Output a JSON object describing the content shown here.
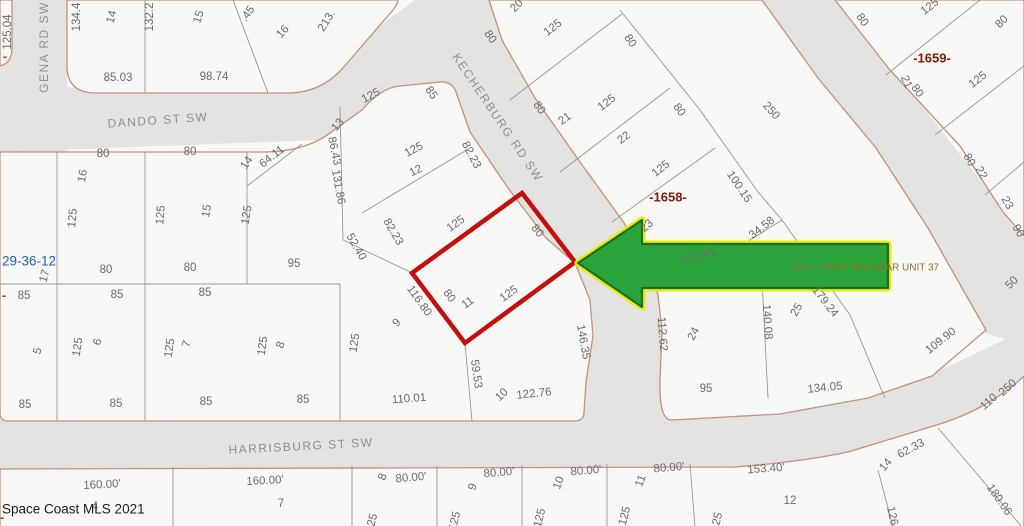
{
  "map": {
    "type": "plat-parcel-map",
    "watermark": "Space Coast MLS 2021",
    "section_label": "29-36-12",
    "streets": [
      "GENA RD SW",
      "DANDO ST SW",
      "KECHERBURG RD SW",
      "HARRISBURG ST SW"
    ],
    "plat_numbers": [
      "-1658-",
      "-1659-"
    ],
    "unit_label": "#KH - PORT MALABAR UNIT 37",
    "highlighted_parcel": {
      "lot": "11",
      "frontage": "80",
      "depth": "125"
    },
    "labels": [
      {
        "t": "125.04",
        "x": 8,
        "y": 32,
        "r": -90,
        "k": "d"
      },
      {
        "t": "-",
        "x": 5,
        "y": 57,
        "r": 0,
        "k": "rd"
      },
      {
        "t": "134.4",
        "x": 77,
        "y": 17,
        "r": -90,
        "k": "d"
      },
      {
        "t": "14",
        "x": 112,
        "y": 17,
        "r": -75,
        "k": "d"
      },
      {
        "t": "132.2",
        "x": 150,
        "y": 17,
        "r": -90,
        "k": "d"
      },
      {
        "t": "15",
        "x": 199,
        "y": 17,
        "r": -72,
        "k": "d"
      },
      {
        "t": ".45",
        "x": 248,
        "y": 14,
        "r": -55,
        "k": "d"
      },
      {
        "t": "16",
        "x": 283,
        "y": 32,
        "r": -48,
        "k": "d"
      },
      {
        "t": "213.",
        "x": 327,
        "y": 21,
        "r": -58,
        "k": "d"
      },
      {
        "t": "85.03",
        "x": 118,
        "y": 78,
        "r": 0,
        "k": "d"
      },
      {
        "t": "98.74",
        "x": 214,
        "y": 77,
        "r": 0,
        "k": "d"
      },
      {
        "t": "GENA RD SW",
        "x": 45,
        "y": 47,
        "r": -90,
        "k": "st"
      },
      {
        "t": "DANDO ST SW",
        "x": 158,
        "y": 121,
        "r": -4,
        "k": "st"
      },
      {
        "t": "80",
        "x": 103,
        "y": 154,
        "r": 0,
        "k": "d"
      },
      {
        "t": "80",
        "x": 190,
        "y": 152,
        "r": 0,
        "k": "d"
      },
      {
        "t": "14",
        "x": 247,
        "y": 163,
        "r": -55,
        "k": "d"
      },
      {
        "t": "64.11",
        "x": 272,
        "y": 157,
        "r": -38,
        "k": "d"
      },
      {
        "t": "16",
        "x": 83,
        "y": 176,
        "r": -80,
        "k": "d"
      },
      {
        "t": "125",
        "x": 73,
        "y": 218,
        "r": -85,
        "k": "d"
      },
      {
        "t": "125",
        "x": 161,
        "y": 215,
        "r": -85,
        "k": "d"
      },
      {
        "t": "15",
        "x": 207,
        "y": 211,
        "r": -80,
        "k": "d"
      },
      {
        "t": "125",
        "x": 247,
        "y": 215,
        "r": -80,
        "k": "d"
      },
      {
        "t": "29-36-12",
        "x": 2,
        "y": 262,
        "r": 0,
        "k": "sec"
      },
      {
        "t": "17",
        "x": 45,
        "y": 276,
        "r": -75,
        "k": "d"
      },
      {
        "t": "80",
        "x": 106,
        "y": 270,
        "r": 0,
        "k": "d"
      },
      {
        "t": "80",
        "x": 190,
        "y": 268,
        "r": 0,
        "k": "d"
      },
      {
        "t": "95",
        "x": 294,
        "y": 264,
        "r": 0,
        "k": "d"
      },
      {
        "t": "-",
        "x": 4,
        "y": 296,
        "r": 0,
        "k": "rd"
      },
      {
        "t": "85",
        "x": 24,
        "y": 296,
        "r": 0,
        "k": "d"
      },
      {
        "t": "85",
        "x": 117,
        "y": 295,
        "r": 0,
        "k": "d"
      },
      {
        "t": "85",
        "x": 205,
        "y": 293,
        "r": 0,
        "k": "d"
      },
      {
        "t": "5",
        "x": 38,
        "y": 351,
        "r": -75,
        "k": "d"
      },
      {
        "t": "125",
        "x": 78,
        "y": 347,
        "r": -82,
        "k": "d"
      },
      {
        "t": "6",
        "x": 98,
        "y": 342,
        "r": -75,
        "k": "d"
      },
      {
        "t": "125",
        "x": 170,
        "y": 348,
        "r": -82,
        "k": "d"
      },
      {
        "t": "7",
        "x": 187,
        "y": 344,
        "r": -75,
        "k": "d"
      },
      {
        "t": "125",
        "x": 263,
        "y": 346,
        "r": -82,
        "k": "d"
      },
      {
        "t": "8",
        "x": 281,
        "y": 345,
        "r": -70,
        "k": "d"
      },
      {
        "t": "125",
        "x": 355,
        "y": 343,
        "r": -82,
        "k": "d"
      },
      {
        "t": "9",
        "x": 397,
        "y": 323,
        "r": -45,
        "k": "d"
      },
      {
        "t": "85",
        "x": 25,
        "y": 405,
        "r": 0,
        "k": "d"
      },
      {
        "t": "85",
        "x": 116,
        "y": 404,
        "r": 0,
        "k": "d"
      },
      {
        "t": "85",
        "x": 206,
        "y": 402,
        "r": 0,
        "k": "d"
      },
      {
        "t": "85",
        "x": 303,
        "y": 400,
        "r": 0,
        "k": "d"
      },
      {
        "t": "110.01",
        "x": 409,
        "y": 399,
        "r": -4,
        "k": "d"
      },
      {
        "t": "59.53",
        "x": 476,
        "y": 374,
        "r": 82,
        "k": "d"
      },
      {
        "t": "10",
        "x": 502,
        "y": 395,
        "r": -45,
        "k": "d"
      },
      {
        "t": "122.76",
        "x": 534,
        "y": 394,
        "r": -6,
        "k": "d"
      },
      {
        "t": "HARRISBURG ST SW",
        "x": 301,
        "y": 447,
        "r": -3,
        "k": "st"
      },
      {
        "t": "13",
        "x": 338,
        "y": 125,
        "r": -50,
        "k": "d"
      },
      {
        "t": "125",
        "x": 371,
        "y": 96,
        "r": -28,
        "k": "d"
      },
      {
        "t": "85",
        "x": 431,
        "y": 93,
        "r": 55,
        "k": "d"
      },
      {
        "t": "86.43",
        "x": 334,
        "y": 151,
        "r": 78,
        "k": "d"
      },
      {
        "t": "131.86",
        "x": 338,
        "y": 187,
        "r": 80,
        "k": "d"
      },
      {
        "t": "12",
        "x": 416,
        "y": 171,
        "r": -25,
        "k": "d"
      },
      {
        "t": "125",
        "x": 414,
        "y": 150,
        "r": -28,
        "k": "d"
      },
      {
        "t": "82.23",
        "x": 471,
        "y": 155,
        "r": 62,
        "k": "d"
      },
      {
        "t": "82.23",
        "x": 393,
        "y": 232,
        "r": 60,
        "k": "d"
      },
      {
        "t": "52.40",
        "x": 356,
        "y": 247,
        "r": 60,
        "k": "d"
      },
      {
        "t": "116.80",
        "x": 419,
        "y": 301,
        "r": 55,
        "k": "d"
      },
      {
        "t": "125",
        "x": 456,
        "y": 224,
        "r": -36,
        "k": "d"
      },
      {
        "t": "80",
        "x": 537,
        "y": 231,
        "r": 52,
        "k": "d"
      },
      {
        "t": "80",
        "x": 449,
        "y": 296,
        "r": 55,
        "k": "d"
      },
      {
        "t": "125",
        "x": 509,
        "y": 294,
        "r": -36,
        "k": "d"
      },
      {
        "t": "11",
        "x": 468,
        "y": 303,
        "r": -36,
        "k": "d"
      },
      {
        "t": "146.35",
        "x": 583,
        "y": 342,
        "r": 80,
        "k": "d"
      },
      {
        "t": "KECHERBURG RD SW",
        "x": 497,
        "y": 118,
        "r": 56,
        "k": "st"
      },
      {
        "t": "20",
        "x": 517,
        "y": 6,
        "r": -45,
        "k": "d"
      },
      {
        "t": "80",
        "x": 490,
        "y": 37,
        "r": 55,
        "k": "d"
      },
      {
        "t": "125",
        "x": 553,
        "y": 28,
        "r": -38,
        "k": "d"
      },
      {
        "t": "80",
        "x": 630,
        "y": 41,
        "r": 55,
        "k": "d"
      },
      {
        "t": "80",
        "x": 539,
        "y": 108,
        "r": 55,
        "k": "d"
      },
      {
        "t": "21",
        "x": 565,
        "y": 119,
        "r": -36,
        "k": "d"
      },
      {
        "t": "125",
        "x": 607,
        "y": 103,
        "r": -38,
        "k": "d"
      },
      {
        "t": "80",
        "x": 679,
        "y": 110,
        "r": 55,
        "k": "d"
      },
      {
        "t": "22",
        "x": 624,
        "y": 138,
        "r": -36,
        "k": "d"
      },
      {
        "t": "125",
        "x": 661,
        "y": 169,
        "r": -38,
        "k": "d"
      },
      {
        "t": "-1658-",
        "x": 668,
        "y": 198,
        "r": 0,
        "k": "pl"
      },
      {
        "t": "23",
        "x": 647,
        "y": 226,
        "r": -42,
        "k": "d"
      },
      {
        "t": "100.15",
        "x": 739,
        "y": 187,
        "r": 56,
        "k": "d"
      },
      {
        "t": "34.58",
        "x": 762,
        "y": 228,
        "r": -38,
        "k": "d"
      },
      {
        "t": "103.45",
        "x": 698,
        "y": 257,
        "r": -16,
        "k": "d"
      },
      {
        "t": "250",
        "x": 771,
        "y": 111,
        "r": 48,
        "k": "d"
      },
      {
        "t": "112.62",
        "x": 662,
        "y": 334,
        "r": 86,
        "k": "d"
      },
      {
        "t": "24",
        "x": 694,
        "y": 334,
        "r": -62,
        "k": "d"
      },
      {
        "t": "140.08",
        "x": 767,
        "y": 322,
        "r": 86,
        "k": "d"
      },
      {
        "t": "25",
        "x": 797,
        "y": 310,
        "r": -60,
        "k": "d"
      },
      {
        "t": "179.24",
        "x": 825,
        "y": 302,
        "r": 52,
        "k": "d"
      },
      {
        "t": "95",
        "x": 706,
        "y": 389,
        "r": 0,
        "k": "d"
      },
      {
        "t": "134.05",
        "x": 825,
        "y": 388,
        "r": -6,
        "k": "d"
      },
      {
        "t": "#KH - PORT MALABAR UNIT 37",
        "x": 866,
        "y": 268,
        "r": 0,
        "k": "un"
      },
      {
        "t": "80",
        "x": 862,
        "y": 20,
        "r": 55,
        "k": "d"
      },
      {
        "t": "125",
        "x": 930,
        "y": 7,
        "r": -38,
        "k": "d"
      },
      {
        "t": "-1659-",
        "x": 932,
        "y": 59,
        "r": 0,
        "k": "pl"
      },
      {
        "t": "80",
        "x": 1002,
        "y": 22,
        "r": -45,
        "k": "d"
      },
      {
        "t": "21",
        "x": 906,
        "y": 82,
        "r": 68,
        "k": "d"
      },
      {
        "t": "80",
        "x": 917,
        "y": 91,
        "r": 55,
        "k": "d"
      },
      {
        "t": "125",
        "x": 978,
        "y": 80,
        "r": -38,
        "k": "d"
      },
      {
        "t": "80",
        "x": 969,
        "y": 160,
        "r": 60,
        "k": "d"
      },
      {
        "t": "22",
        "x": 981,
        "y": 173,
        "r": 60,
        "k": "d"
      },
      {
        "t": "23",
        "x": 1007,
        "y": 203,
        "r": 60,
        "k": "d"
      },
      {
        "t": "90",
        "x": 1018,
        "y": 231,
        "r": 60,
        "k": "d"
      },
      {
        "t": "50",
        "x": 1012,
        "y": 283,
        "r": -45,
        "k": "d"
      },
      {
        "t": "109.90",
        "x": 941,
        "y": 341,
        "r": -38,
        "k": "d"
      },
      {
        "t": "110",
        "x": 989,
        "y": 402,
        "r": -42,
        "k": "d"
      },
      {
        "t": "250",
        "x": 1008,
        "y": 388,
        "r": -42,
        "k": "d"
      },
      {
        "t": "62.33",
        "x": 911,
        "y": 449,
        "r": -28,
        "k": "d"
      },
      {
        "t": "14",
        "x": 886,
        "y": 465,
        "r": -50,
        "k": "d"
      },
      {
        "t": "153.40'",
        "x": 766,
        "y": 469,
        "r": -4,
        "k": "d"
      },
      {
        "t": "12",
        "x": 790,
        "y": 501,
        "r": 0,
        "k": "d"
      },
      {
        "t": "126",
        "x": 892,
        "y": 516,
        "r": 78,
        "k": "d"
      },
      {
        "t": "180.06",
        "x": 999,
        "y": 500,
        "r": 55,
        "k": "d"
      },
      {
        "t": "125",
        "x": 717,
        "y": 522,
        "r": -75,
        "k": "d"
      },
      {
        "t": "8",
        "x": 383,
        "y": 477,
        "r": -70,
        "k": "d"
      },
      {
        "t": "80.00'",
        "x": 411,
        "y": 478,
        "r": -5,
        "k": "d"
      },
      {
        "t": "9",
        "x": 473,
        "y": 487,
        "r": -70,
        "k": "d"
      },
      {
        "t": "80.00'",
        "x": 499,
        "y": 473,
        "r": -5,
        "k": "d"
      },
      {
        "t": "10",
        "x": 559,
        "y": 483,
        "r": -70,
        "k": "d"
      },
      {
        "t": "80.00'",
        "x": 586,
        "y": 471,
        "r": -5,
        "k": "d"
      },
      {
        "t": "11",
        "x": 641,
        "y": 481,
        "r": -70,
        "k": "d"
      },
      {
        "t": "80.00'",
        "x": 669,
        "y": 468,
        "r": -5,
        "k": "d"
      },
      {
        "t": "125",
        "x": 372,
        "y": 523,
        "r": -75,
        "k": "d"
      },
      {
        "t": "125",
        "x": 455,
        "y": 521,
        "r": -75,
        "k": "d"
      },
      {
        "t": "125",
        "x": 540,
        "y": 518,
        "r": -75,
        "k": "d"
      },
      {
        "t": "125",
        "x": 625,
        "y": 516,
        "r": -75,
        "k": "d"
      },
      {
        "t": "160.00'",
        "x": 102,
        "y": 485,
        "r": -3,
        "k": "d"
      },
      {
        "t": "4",
        "x": 95,
        "y": 507,
        "r": 0,
        "k": "d"
      },
      {
        "t": "160.00'",
        "x": 265,
        "y": 481,
        "r": -3,
        "k": "d"
      },
      {
        "t": "7",
        "x": 281,
        "y": 504,
        "r": 0,
        "k": "d"
      },
      {
        "t": "Space Coast MLS 2021",
        "x": 2,
        "y": 510,
        "r": 0,
        "k": "wm"
      },
      {
        "t": "-",
        "x": 2,
        "y": 518,
        "r": 0,
        "k": "rd"
      }
    ]
  },
  "colors": {
    "bg": "#f8f8f6",
    "block_fill": "#f8f8f6",
    "road_fill": "#e3e3e1",
    "boundary_tan": "#c4917c",
    "lot_line": "#98988f",
    "parcel_outline": "#c50f0f",
    "arrow_fill": "#2aa33b",
    "arrow_glow": "#ecec06",
    "arrow_edge": "#157022",
    "plat_red": "#801a0f",
    "section_blue": "#2061c2",
    "unit_khaki": "#8d7031",
    "text_gray": "#6b6b69",
    "street_gray": "#90908e",
    "watermark": "#1b1b1b",
    "dash_red": "#c03326"
  }
}
